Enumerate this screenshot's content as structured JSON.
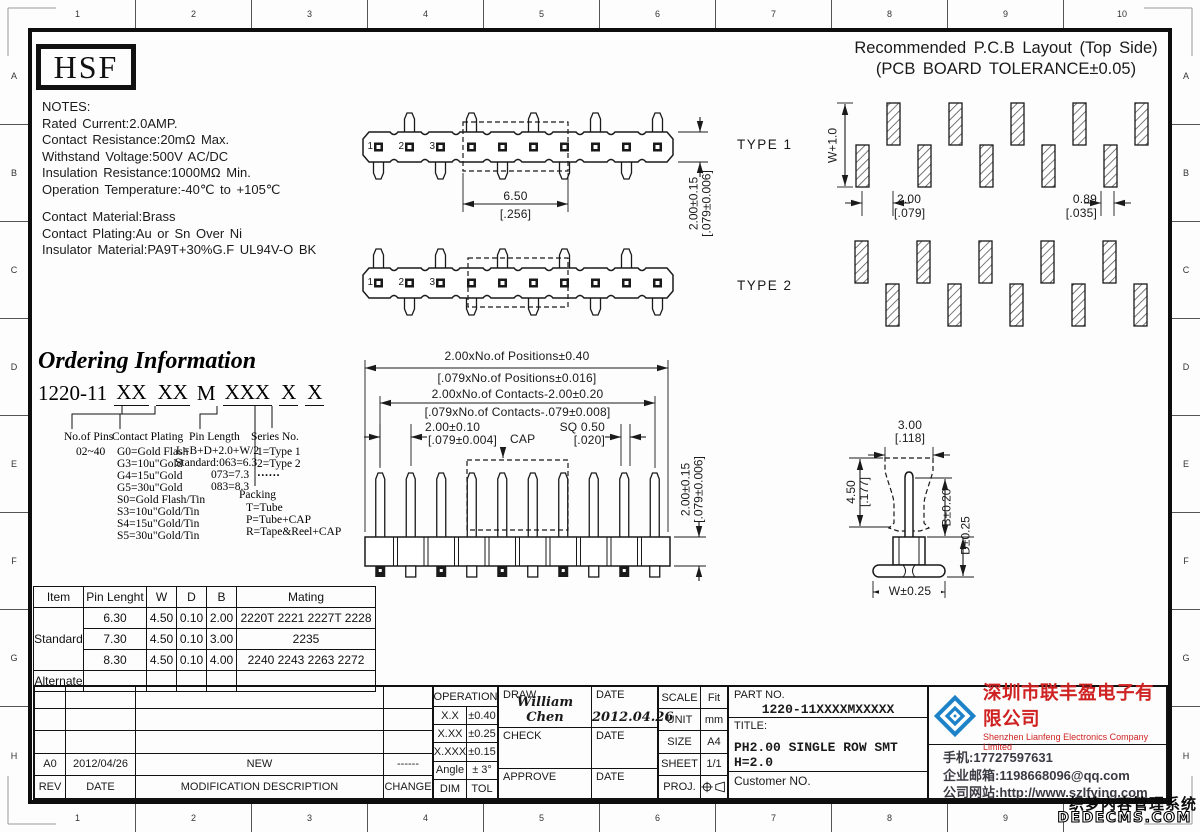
{
  "sheet": {
    "ruler_numbers": [
      "1",
      "2",
      "3",
      "4",
      "5",
      "6",
      "7",
      "8",
      "9",
      "10"
    ],
    "ruler_letters": [
      "A",
      "B",
      "C",
      "D",
      "E",
      "F",
      "G",
      "H"
    ]
  },
  "logo": "HSF",
  "notes": {
    "lines": [
      "NOTES:",
      "Rated Current:2.0AMP.",
      "Contact Resistance:20mΩ Max.",
      "Withstand Voltage:500V AC/DC",
      "Insulation Resistance:1000MΩ Min.",
      "Operation Temperature:-40℃ to +105℃",
      "Contact Material:Brass",
      "Contact Plating:Au or Sn Over Ni",
      "Insulator Material:PA9T+30%G.F UL94V-O BK"
    ]
  },
  "pcb_layout": {
    "title_line1": "Recommended P.C.B Layout (Top Side)",
    "title_line2": "(PCB BOARD TOLERANCE±0.05)",
    "dim_w": "W+1.0",
    "pitch_mm": "2.00",
    "pitch_in": "[.079]",
    "pad_mm": "0.89",
    "pad_in": "[.035]"
  },
  "types": {
    "type1": "TYPE 1",
    "type2": "TYPE 2",
    "pin_numbers": [
      "1",
      "2",
      "3"
    ]
  },
  "top_dims": {
    "span_mm": "6.50",
    "span_in": "[.256]",
    "height_mm": "2.00±0.15",
    "height_in": "[.079±0.006]"
  },
  "front_dims": {
    "positions_mm": "2.00xNo.of Positions±0.40",
    "positions_in": "[.079xNo.of Positions±0.016]",
    "contacts_mm": "2.00xNo.of Contacts-2.00±0.20",
    "contacts_in": "[.079xNo.of Contacts-.079±0.008]",
    "pitch_mm": "2.00±0.10",
    "pitch_in": "[.079±0.004]",
    "cap": "CAP",
    "sq_mm": "SQ 0.50",
    "sq_in": "[.020]",
    "height_mm": "2.00±0.15",
    "height_in": "[.079±0.006]"
  },
  "side_dims": {
    "w3": "3.00",
    "w3_in": "[.118]",
    "h45": "4.50",
    "h45_in": "[.177]",
    "b": "B±0.20",
    "d": "D±0.25",
    "w": "W±0.25"
  },
  "ordering": {
    "title": "Ordering Information",
    "code_prefix": "1220-11",
    "g1": "XX",
    "g2": "XX",
    "m": "M",
    "g3": "XXX",
    "g4": "X",
    "g5": "X",
    "pins_header": "No.of Pins",
    "pins_value": "02~40",
    "plating_header": "Contact Plating",
    "plating_items": [
      "G0=Gold Flash",
      "G3=10u\"Gold",
      "G4=15u\"Gold",
      "G5=30u\"Gold",
      "S0=Gold Flash/Tin",
      "S3=10u\"Gold/Tin",
      "S4=15u\"Gold/Tin",
      "S5=30u\"Gold/Tin"
    ],
    "length_header": "Pin Length",
    "length_items": [
      "L=B+D+2.0+W/2",
      "Standard:063=6.3",
      "073=7.3",
      "083=8.3"
    ],
    "series_header": "Series No.",
    "series_items": [
      "1=Type 1",
      "2=Type 2",
      "······"
    ],
    "packing_header": "Packing",
    "packing_items": [
      "T=Tube",
      "P=Tube+CAP",
      "R=Tape&Reel+CAP"
    ]
  },
  "spec_table": {
    "headers": [
      "Item",
      "Pin Lenght",
      "W",
      "D",
      "B",
      "Mating"
    ],
    "standard_label": "Standard",
    "alternate_label": "Alternate",
    "rows": [
      [
        "6.30",
        "4.50",
        "0.10",
        "2.00",
        "2220T 2221 2227T 2228"
      ],
      [
        "7.30",
        "4.50",
        "0.10",
        "3.00",
        "2235"
      ],
      [
        "8.30",
        "4.50",
        "0.10",
        "4.00",
        "2240 2243 2263 2272"
      ]
    ]
  },
  "title_block": {
    "revision": {
      "rev": "A0",
      "date": "2012/04/26",
      "desc": "NEW",
      "change": "------",
      "h_rev": "REV",
      "h_date": "DATE",
      "h_desc": "MODIFICATION  DESCRIPTION",
      "h_change": "CHANGE"
    },
    "operation": {
      "header": "OPERATION",
      "rows": [
        [
          "X.X",
          "±0.40"
        ],
        [
          "X.XX",
          "±0.25"
        ],
        [
          "X.XXX",
          "±0.15"
        ],
        [
          "Angle",
          "± 3°"
        ],
        [
          "DIM",
          "TOL"
        ]
      ]
    },
    "sign": {
      "draw_label": "DRAW",
      "check_label": "CHECK",
      "approve_label": "APPROVE",
      "date_label": "DATE",
      "drawer": "William Chen",
      "draw_date": "2012.04.26"
    },
    "info": {
      "scale_label": "SCALE",
      "scale": "Fit",
      "unit_label": "UNIT",
      "unit": "mm",
      "size_label": "SIZE",
      "size": "A4",
      "sheet_label": "SHEET",
      "sheet": "1/1",
      "proj_label": "PROJ."
    },
    "part": {
      "part_no_label": "PART NO.",
      "part_no": "1220-11XXXXMXXXXX",
      "title_label": "TITLE:",
      "title": "PH2.00 SINGLE ROW SMT H=2.0",
      "customer_label": "Customer NO."
    },
    "company": {
      "name_cn": "深圳市联丰盈电子有限公司",
      "name_en": "Shenzhen Lianfeng Electronics Company Limited",
      "phone": "手机:17727597631",
      "email": "企业邮箱:1198668096@qq.com",
      "website": "公司网站:http://www.szlfying.com"
    }
  },
  "watermark": {
    "line1": "织梦内容管理系统",
    "line2": "DEDECMS.COM"
  },
  "colors": {
    "line": "#1a1a1a",
    "company_red": "#cf2222",
    "logo_blue": "#1e82c8"
  }
}
